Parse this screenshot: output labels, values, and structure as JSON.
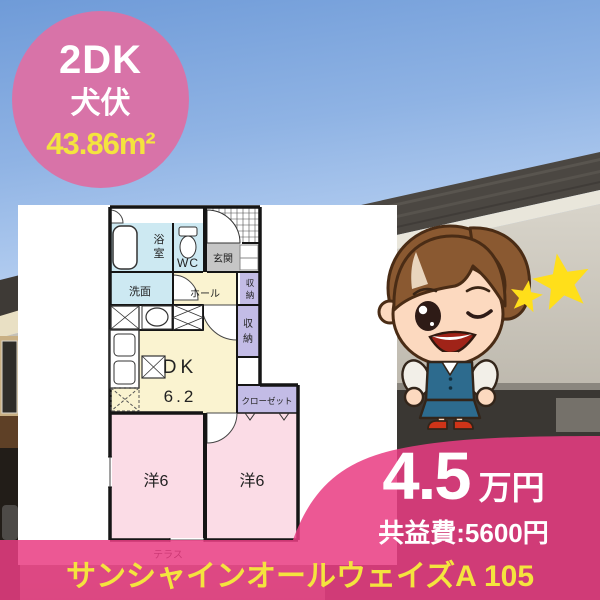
{
  "badge": {
    "layout": "2DK",
    "location": "犬伏",
    "area": "43.86m²"
  },
  "floorplan": {
    "bath": [
      "浴",
      "室"
    ],
    "wc": "WC",
    "entrance": "玄関",
    "washroom": "洗面",
    "hall": "ホール",
    "storage_upper": [
      "収",
      "納"
    ],
    "storage_lower": [
      "収",
      "納"
    ],
    "dk": "DK",
    "dk_size": "6.2",
    "closet": "クローゼット",
    "room_left": "洋6",
    "room_right": "洋6",
    "terrace": "テラス"
  },
  "price": {
    "amount": "4.5",
    "unit": "万円",
    "common_fee": "共益費:5600円"
  },
  "banner": {
    "property_name": "サンシャインオールウェイズA 105"
  },
  "mascot": {
    "name": "office-lady-winking-mascot",
    "stars": "two-yellow-stars"
  },
  "colors": {
    "accent_pink": "#E93C82",
    "badge_pink": "#D873A8",
    "highlight_yellow": "#F4E43E",
    "room_pink": "#FBDCE6",
    "room_cream": "#FAF3D0",
    "room_blue": "#CDE9F2",
    "room_purple": "#C3BCE6",
    "sky_blue": "#7FA6DD"
  }
}
